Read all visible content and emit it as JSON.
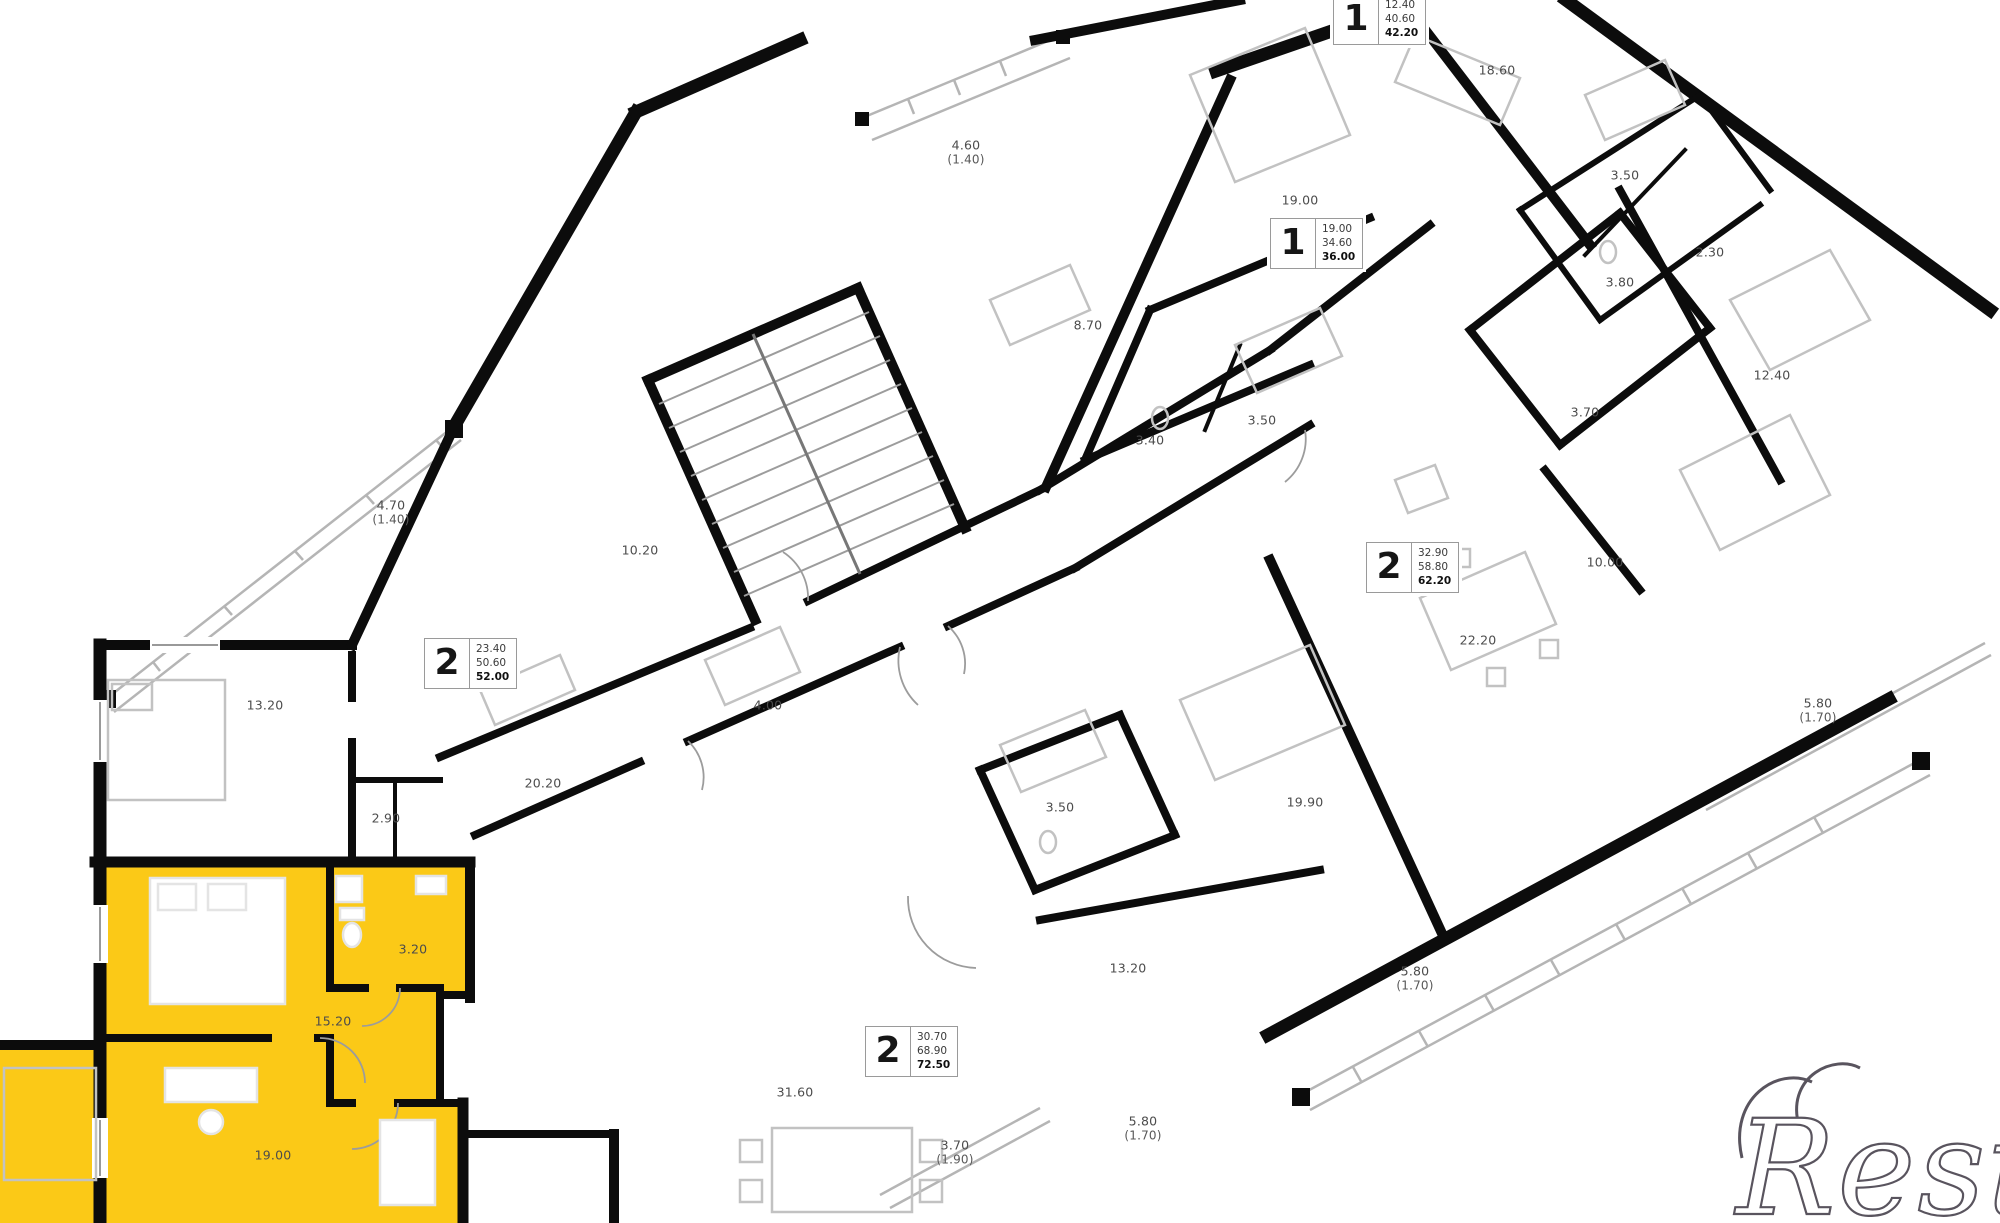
{
  "watermark": {
    "text": "Restate"
  },
  "colors": {
    "highlight": "#FBC917",
    "walls": "#0C0C0C",
    "label_text": "#4C4C4C"
  },
  "apartments": [
    {
      "type": "1",
      "values": [
        "12.40",
        "40.60",
        "42.20"
      ],
      "x": 1333,
      "y": -6
    },
    {
      "type": "1",
      "values": [
        "19.00",
        "34.60",
        "36.00"
      ],
      "x": 1270,
      "y": 218
    },
    {
      "type": "2",
      "values": [
        "23.40",
        "50.60",
        "52.00"
      ],
      "x": 424,
      "y": 638
    },
    {
      "type": "2",
      "values": [
        "32.90",
        "58.80",
        "62.20"
      ],
      "x": 1366,
      "y": 542
    },
    {
      "type": "2",
      "values": [
        "30.70",
        "68.90",
        "72.50"
      ],
      "x": 865,
      "y": 1026
    }
  ],
  "rooms": [
    {
      "label": "4.70",
      "sub": "(1.40)",
      "x": 391,
      "y": 512
    },
    {
      "label": "13.20",
      "sub": "",
      "x": 265,
      "y": 705
    },
    {
      "label": "10.20",
      "sub": "",
      "x": 640,
      "y": 550
    },
    {
      "label": "4.00",
      "sub": "",
      "x": 768,
      "y": 705
    },
    {
      "label": "20.20",
      "sub": "",
      "x": 543,
      "y": 783
    },
    {
      "label": "2.90",
      "sub": "",
      "x": 386,
      "y": 818
    },
    {
      "label": "3.20",
      "sub": "",
      "x": 413,
      "y": 949
    },
    {
      "label": "15.20",
      "sub": "",
      "x": 333,
      "y": 1021
    },
    {
      "label": "19.00",
      "sub": "",
      "x": 273,
      "y": 1155
    },
    {
      "label": "4.60",
      "sub": "(1.40)",
      "x": 966,
      "y": 152
    },
    {
      "label": "19.00",
      "sub": "",
      "x": 1300,
      "y": 200
    },
    {
      "label": "8.70",
      "sub": "",
      "x": 1088,
      "y": 325
    },
    {
      "label": "3.40",
      "sub": "",
      "x": 1150,
      "y": 440
    },
    {
      "label": "3.50",
      "sub": "",
      "x": 1262,
      "y": 420
    },
    {
      "label": "18.60",
      "sub": "",
      "x": 1497,
      "y": 70
    },
    {
      "label": "3.50",
      "sub": "",
      "x": 1625,
      "y": 175
    },
    {
      "label": "2.30",
      "sub": "",
      "x": 1710,
      "y": 252
    },
    {
      "label": "3.80",
      "sub": "",
      "x": 1620,
      "y": 282
    },
    {
      "label": "12.40",
      "sub": "",
      "x": 1772,
      "y": 375
    },
    {
      "label": "3.70",
      "sub": "",
      "x": 1585,
      "y": 412
    },
    {
      "label": "10.00",
      "sub": "",
      "x": 1605,
      "y": 562
    },
    {
      "label": "22.20",
      "sub": "",
      "x": 1478,
      "y": 640
    },
    {
      "label": "5.80",
      "sub": "(1.70)",
      "x": 1818,
      "y": 710
    },
    {
      "label": "3.50",
      "sub": "",
      "x": 1060,
      "y": 807
    },
    {
      "label": "19.90",
      "sub": "",
      "x": 1305,
      "y": 802
    },
    {
      "label": "13.20",
      "sub": "",
      "x": 1128,
      "y": 968
    },
    {
      "label": "5.80",
      "sub": "(1.70)",
      "x": 1415,
      "y": 978
    },
    {
      "label": "5.80",
      "sub": "(1.70)",
      "x": 1143,
      "y": 1128
    },
    {
      "label": "31.60",
      "sub": "",
      "x": 795,
      "y": 1092
    },
    {
      "label": "3.70",
      "sub": "(1.90)",
      "x": 955,
      "y": 1152
    }
  ]
}
